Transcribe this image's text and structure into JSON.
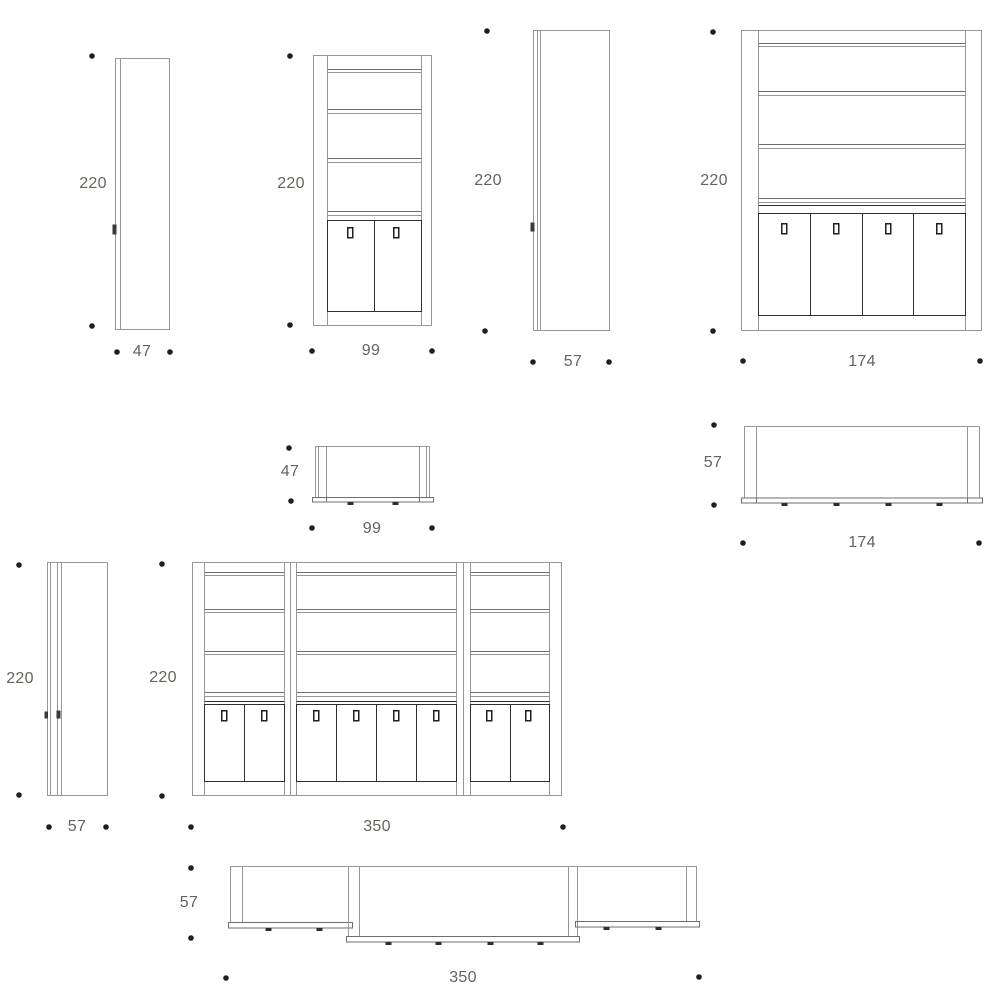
{
  "colors": {
    "background": "#ffffff",
    "line_light": "#979797",
    "line_mid": "#6e6e6e",
    "line_dark": "#2e2e2e",
    "label_text": "#66625d",
    "dimension_dot": "#1f1f1f"
  },
  "views": {
    "side_47": {
      "height": "220",
      "width": "47"
    },
    "front_99": {
      "height": "220",
      "width": "99"
    },
    "side_57_upper": {
      "height": "220",
      "width": "57"
    },
    "front_174": {
      "height": "220",
      "width": "174"
    },
    "top_99": {
      "depth": "47",
      "width": "99"
    },
    "top_174": {
      "depth": "57",
      "width": "174"
    },
    "side_57_lower": {
      "height": "220",
      "width": "57"
    },
    "front_350": {
      "height": "220",
      "width": "350"
    },
    "top_350": {
      "depth": "57",
      "width": "350"
    }
  }
}
